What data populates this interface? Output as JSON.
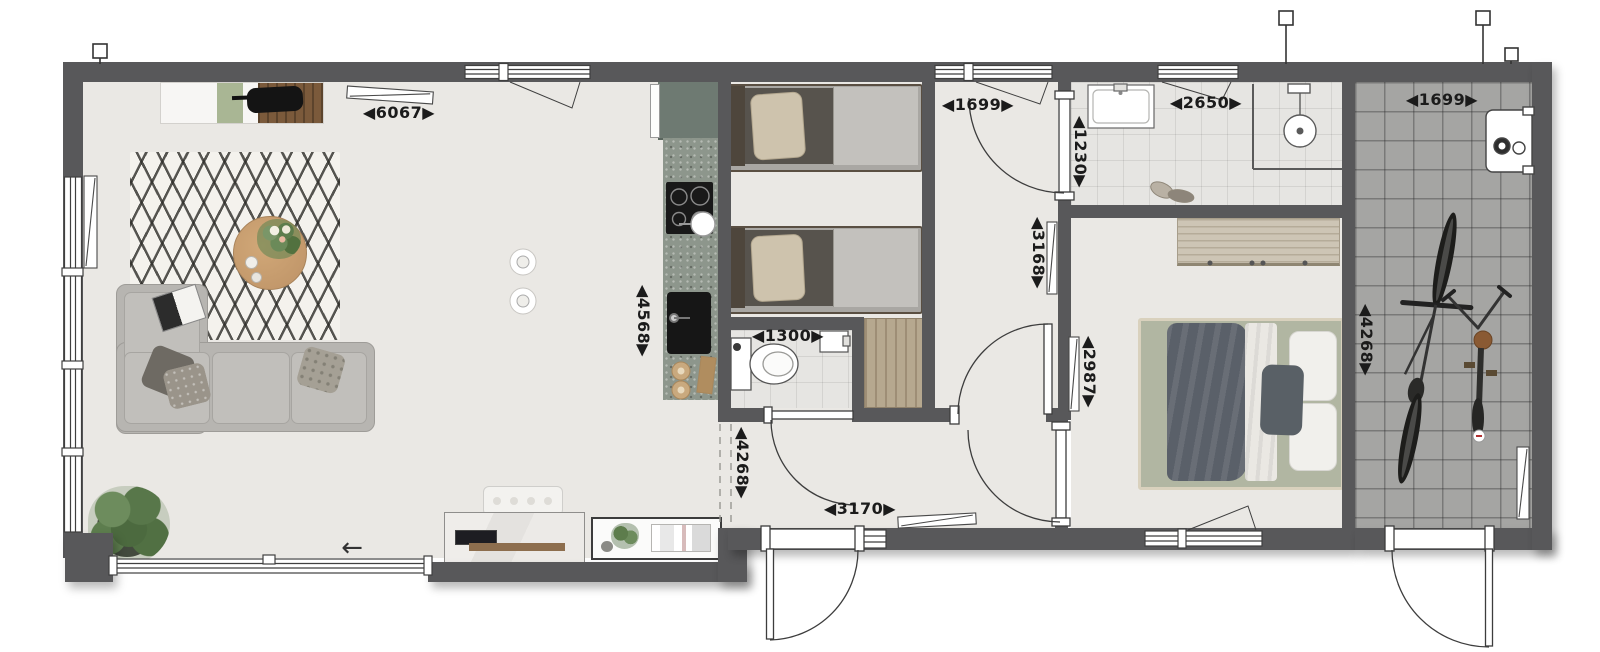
{
  "plan": {
    "dims": {
      "living_width": "◀6067▶",
      "kitchen_depth": "◀4568▶",
      "hallway_width": "◀1699▶",
      "bathroom_width": "◀2650▶",
      "storage_width": "◀1699▶",
      "bathroom_depth": "◀1230▶",
      "hallway_depth": "◀3168▶",
      "bedroom_depth": "◀2987▶",
      "wc_width": "◀1300▶",
      "entrance_width": "◀3170▶",
      "living_depth": "◀4268▶",
      "storage_depth": "◀4268▶"
    },
    "icons": {
      "sliding_door_arrow": "←"
    },
    "colors": {
      "wall": "#58585a",
      "floor": "#eae8e4",
      "tile_light": "#e6e5e2",
      "tile_dark": "#a5a5a3",
      "counter": "#8d968c",
      "wood": "#b5926a",
      "sage_mattress": "#b1b6a2",
      "sofa": "#b7b5b1",
      "accent_green": "#a9b694"
    }
  }
}
